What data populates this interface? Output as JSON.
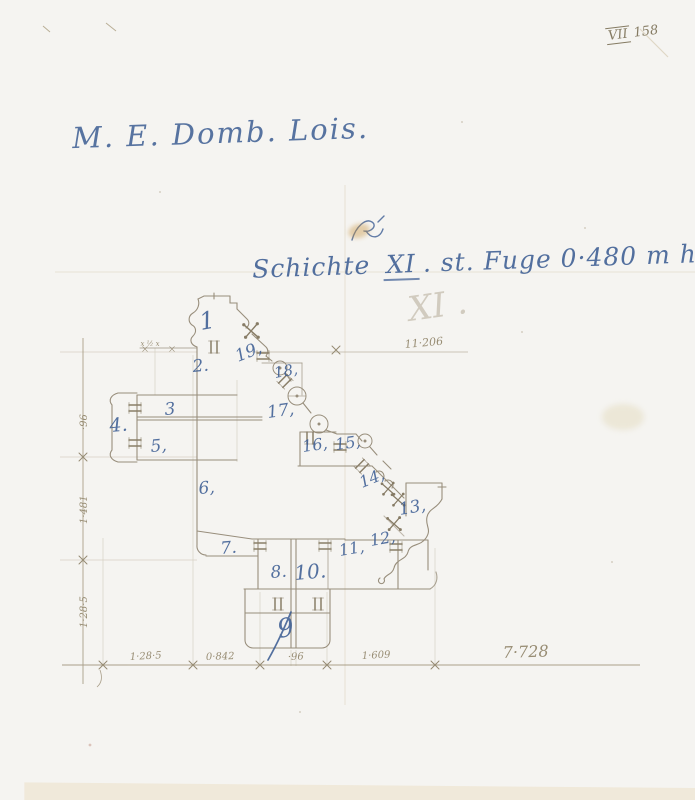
{
  "colors": {
    "paper": "#ece3d0",
    "background": "#f5f4f1",
    "ink": "#3c5d93",
    "pencil": "#988d74"
  },
  "archive_mark": {
    "roman": "VII",
    "number": "158"
  },
  "inscription": "M. E. Domb. Lois.",
  "title": {
    "word": "Schichte",
    "numeral": "XI",
    "rest": ". st. Fuge 0·480 m hoch.",
    "flourish": "Fi",
    "faint_numeral": "XI ."
  },
  "dimensions": {
    "top_width": "11·206",
    "bottom_segments": [
      "1·28·5",
      "0·842",
      "·96",
      "1·609"
    ],
    "bottom_total": "7·728",
    "left_segments": [
      "·96",
      "1·481",
      "1·28·5"
    ],
    "joint_note": "x ½ x"
  },
  "stones": [
    {
      "label": "1"
    },
    {
      "label": "2."
    },
    {
      "label": "3"
    },
    {
      "label": "4."
    },
    {
      "label": "5,"
    },
    {
      "label": "6,"
    },
    {
      "label": "7."
    },
    {
      "label": "8."
    },
    {
      "label": "9"
    },
    {
      "label": "10."
    },
    {
      "label": "11,"
    },
    {
      "label": "12,"
    },
    {
      "label": "13,"
    },
    {
      "label": "14,"
    },
    {
      "label": "15,"
    },
    {
      "label": "16,"
    },
    {
      "label": "17,"
    },
    {
      "label": "18,"
    },
    {
      "label": "19,"
    }
  ]
}
